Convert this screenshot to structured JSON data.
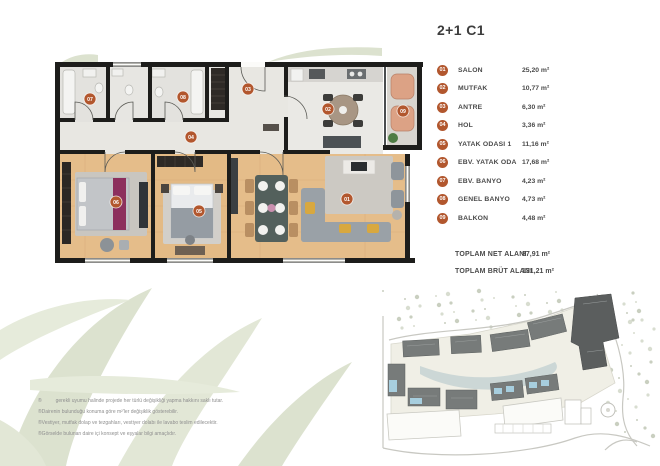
{
  "title": "2+1 C1",
  "legend": {
    "items": [
      {
        "num": "01",
        "name": "SALON",
        "area": "25,20 m²"
      },
      {
        "num": "02",
        "name": "MUTFAK",
        "area": "10,77 m²"
      },
      {
        "num": "03",
        "name": "ANTRE",
        "area": "6,30 m²"
      },
      {
        "num": "04",
        "name": "HOL",
        "area": "3,36 m²"
      },
      {
        "num": "05",
        "name": "YATAK ODASI 1",
        "area": "11,16 m²"
      },
      {
        "num": "06",
        "name": "EBV. YATAK ODA",
        "area": "17,68 m²"
      },
      {
        "num": "07",
        "name": "EBV. BANYO",
        "area": "4,23 m²"
      },
      {
        "num": "08",
        "name": "GENEL BANYO",
        "area": "4,73 m²"
      },
      {
        "num": "09",
        "name": "BALKON",
        "area": "4,48 m²"
      }
    ],
    "totals": [
      {
        "label": "TOPLAM NET  ALANI",
        "value": "87,91 m²"
      },
      {
        "label": "TOPLAM BRÜT  ALANI",
        "value": "131,21 m²"
      }
    ]
  },
  "floorplan": {
    "markers": [
      {
        "num": "01",
        "x": 292,
        "y": 137
      },
      {
        "num": "02",
        "x": 273,
        "y": 47
      },
      {
        "num": "03",
        "x": 193,
        "y": 27
      },
      {
        "num": "04",
        "x": 136,
        "y": 75
      },
      {
        "num": "05",
        "x": 144,
        "y": 149
      },
      {
        "num": "06",
        "x": 61,
        "y": 140
      },
      {
        "num": "07",
        "x": 35,
        "y": 37
      },
      {
        "num": "08",
        "x": 128,
        "y": 35
      },
      {
        "num": "09",
        "x": 348,
        "y": 49
      }
    ]
  },
  "disclaimer": {
    "lines": [
      "®          gerekli uyumu halinde projede her türlü değişikliği yapma hakkını saklı tutar.",
      "®Dairenin bulunduğu konuma göre m²'ler değişiklik gösterebilir.",
      "®Vestiyer, mutfak dolap ve tezgahları, vestiyer dolabı ile lavabo teslim edilecektir.",
      "®Görselde bulunan daire içi konsept ve eşyalar bilgi amaçlıdır."
    ]
  },
  "colors": {
    "badge": "#b2572e",
    "title_text": "#3d3d3d",
    "legend_text": "#4a4a4a",
    "unit_highlight": "#a7cede",
    "wall": "#1d1d1b",
    "wood_floor": "#e5bd8a",
    "tile_floor": "#e6e5e1",
    "watermark": "#dce2cf"
  }
}
